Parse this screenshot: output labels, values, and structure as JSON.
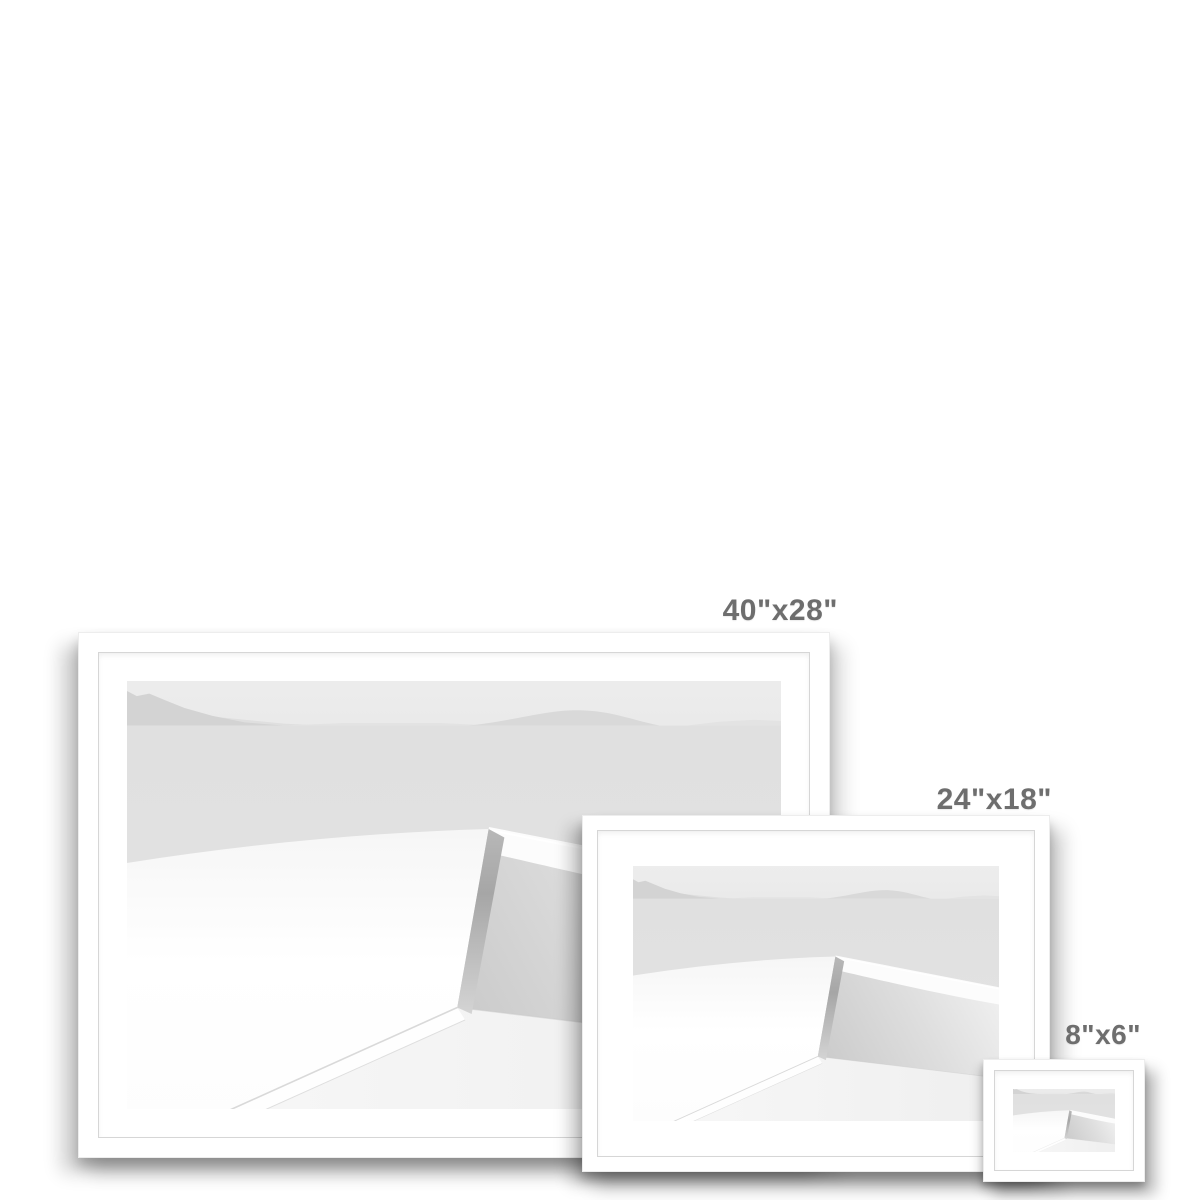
{
  "canvas": {
    "background": "#ffffff"
  },
  "colors": {
    "background": "#ffffff",
    "label": "#6e6e6e",
    "molding": "#ffffff",
    "mat": "#ffffff",
    "rebate": "#d6d6d6",
    "sky": "#eaeaea",
    "sea": "#e2e2e2",
    "mountain": "#d3d3d3",
    "mountain-back": "#dfdfdf",
    "hill": "#d9d9d9",
    "hill-faint": "#e3e3e3",
    "wall": "#ffffff",
    "cap": "#fcfcfc",
    "edge-dark": "#a6a6a6",
    "floor": "#efefef"
  },
  "product": {
    "kind": "framed-print-size-comparison",
    "artwork_description": "high-key black and white seascape: white wall corner, sea and distant hills"
  },
  "frames": [
    {
      "id": "large",
      "size_label": "40\"x28\"",
      "width_in": 40,
      "height_in": 28
    },
    {
      "id": "medium",
      "size_label": "24\"x18\"",
      "width_in": 24,
      "height_in": 18
    },
    {
      "id": "small",
      "size_label": "8\"x6\"",
      "width_in": 8,
      "height_in": 6
    }
  ]
}
